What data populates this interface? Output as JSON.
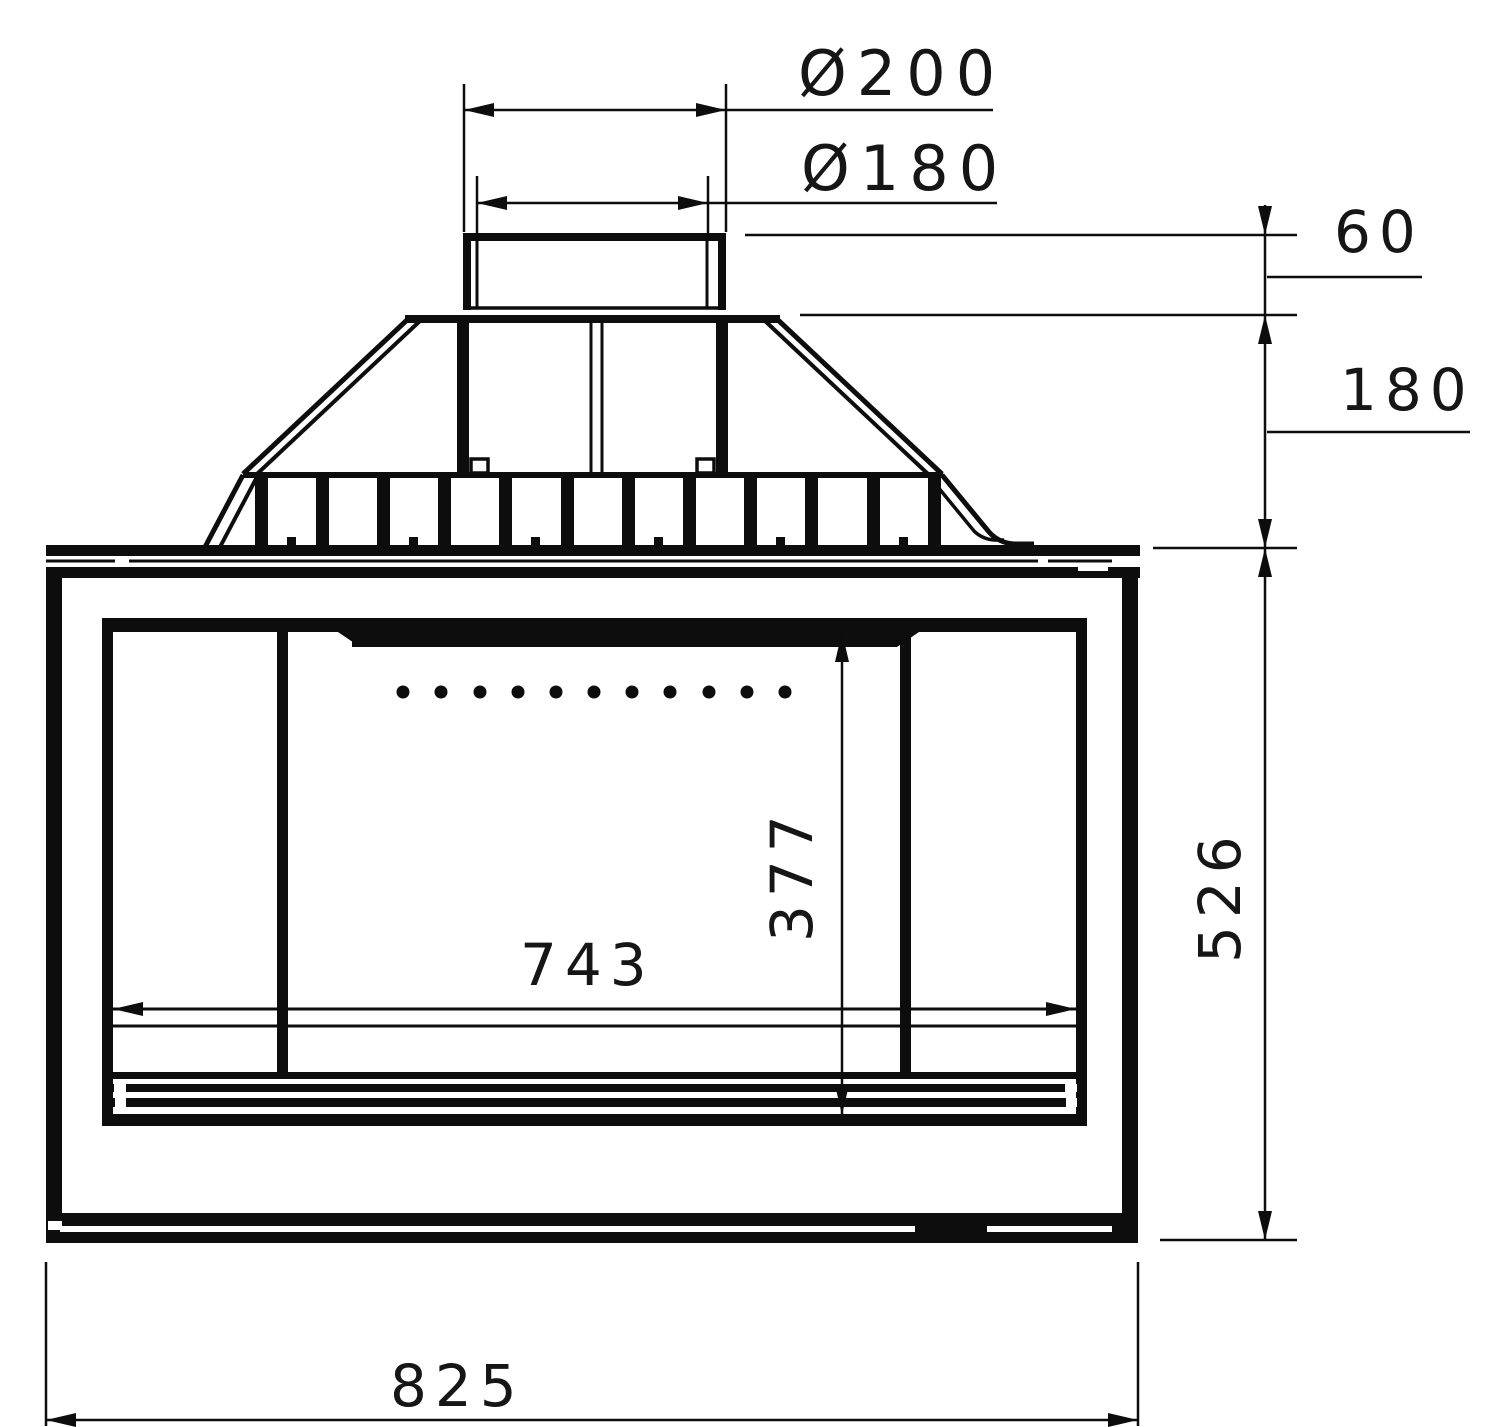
{
  "drawing": {
    "labels": {
      "flue_outer_dia": "Ø200",
      "flue_inner_dia": "Ø180",
      "collar_height": "60",
      "hood_height": "180",
      "body_height": "526",
      "door_opening_height": "377",
      "door_opening_width": "743",
      "overall_width": "825"
    },
    "colors": {
      "line": "#0d0d0d",
      "text": "#161616",
      "background": "#ffffff"
    }
  }
}
